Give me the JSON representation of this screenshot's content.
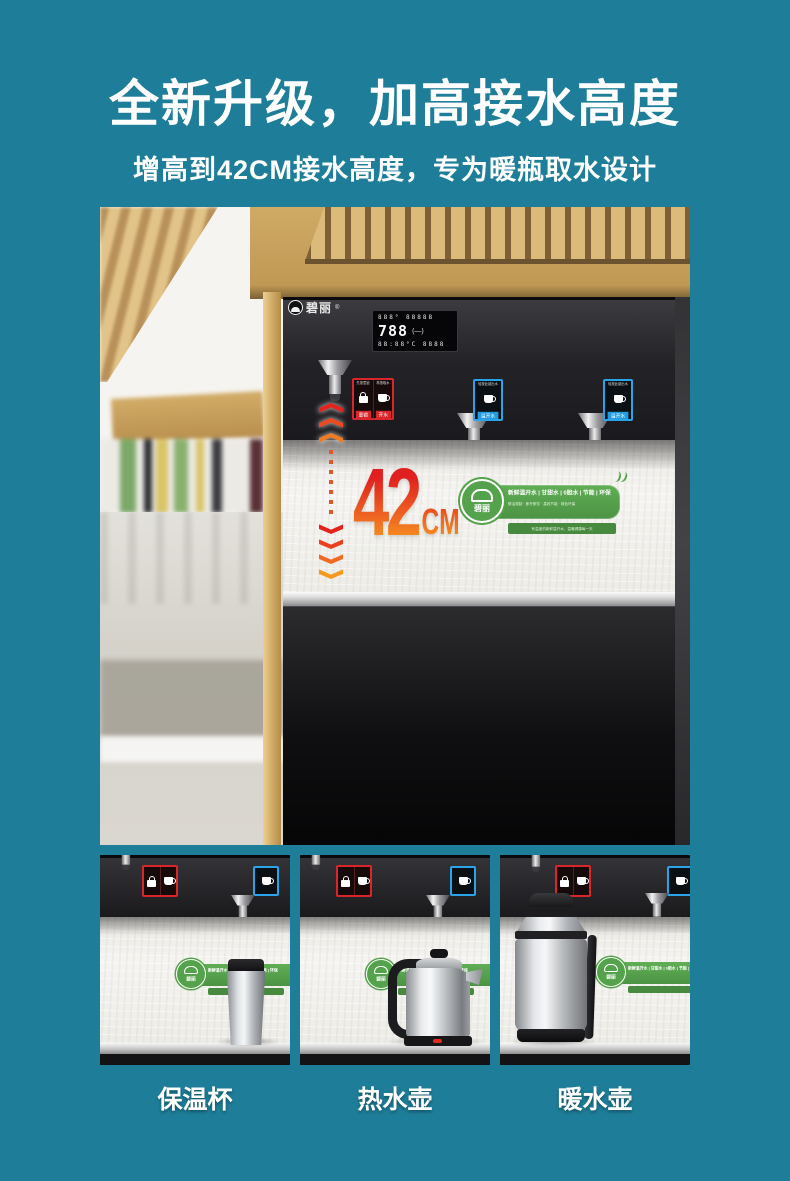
{
  "header": {
    "title": "全新升级，加高接水高度",
    "subtitle": "增高到42CM接水高度，专为暖瓶取水设计"
  },
  "hero": {
    "brand": {
      "name": "碧丽",
      "reg": "®"
    },
    "lcd": {
      "row1": "888°  88888",
      "big": "788",
      "mode": "(—)",
      "row3": "88:88°C  8888"
    },
    "red_panel": {
      "cap_left": "先按童锁",
      "cap_right": "再按取水",
      "label_left": "童锁",
      "label_right": "开水"
    },
    "blue_panel": {
      "caption": "轻按此键出水",
      "label": "温开水"
    },
    "measure": {
      "value": "42",
      "unit": "CM"
    },
    "banner": {
      "brand": "碧丽",
      "features": "新鲜温开水 | 甘甜水 | 0胆水 | 节能 | 环保",
      "sub": "鲜活现制 · 即开即饮 · 高效节能 · 绿色环保",
      "strip": "有温度的新鲜温开水，温暖健康每一天"
    }
  },
  "thumbs": [
    {
      "label": "保温杯"
    },
    {
      "label": "热水壶"
    },
    {
      "label": "暖水壶"
    }
  ],
  "colors": {
    "background": "#1e7e99",
    "machine_black": "#1a1a1d",
    "accent_red": "#d8262a",
    "accent_blue": "#1f9ce0",
    "banner_green": "#55a24c",
    "measure_gradient": [
      "#e01f1f",
      "#f7941d"
    ],
    "wood": "#c9a25f"
  }
}
